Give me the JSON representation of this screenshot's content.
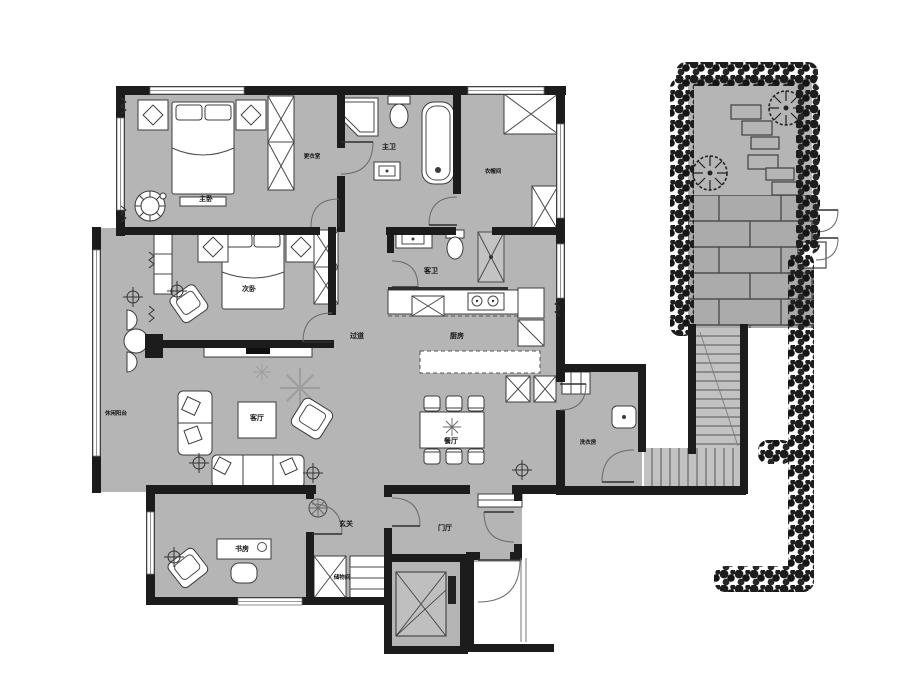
{
  "plan": {
    "rooms": [
      {
        "id": "master-bedroom",
        "label": "主卧"
      },
      {
        "id": "dressing-room",
        "label": "更衣室"
      },
      {
        "id": "master-bath",
        "label": "主卫"
      },
      {
        "id": "cloakroom",
        "label": "衣帽间"
      },
      {
        "id": "second-bedroom",
        "label": "次卧"
      },
      {
        "id": "guest-bath",
        "label": "客卫"
      },
      {
        "id": "kitchen",
        "label": "厨房"
      },
      {
        "id": "hallway",
        "label": "过道"
      },
      {
        "id": "leisure-balcony",
        "label": "休闲阳台"
      },
      {
        "id": "living-room",
        "label": "客厅"
      },
      {
        "id": "dining-room",
        "label": "餐厅"
      },
      {
        "id": "laundry-room",
        "label": "洗衣房"
      },
      {
        "id": "foyer",
        "label": "玄关"
      },
      {
        "id": "entry-hall",
        "label": "门厅"
      },
      {
        "id": "study",
        "label": "书房"
      },
      {
        "id": "storage",
        "label": "储物间"
      }
    ],
    "colors": {
      "floor": "#b5b5b5",
      "wall": "#1c1c1c",
      "fixture": "#ffffff",
      "paper": "#ffffff",
      "paver": "#ababab"
    }
  }
}
